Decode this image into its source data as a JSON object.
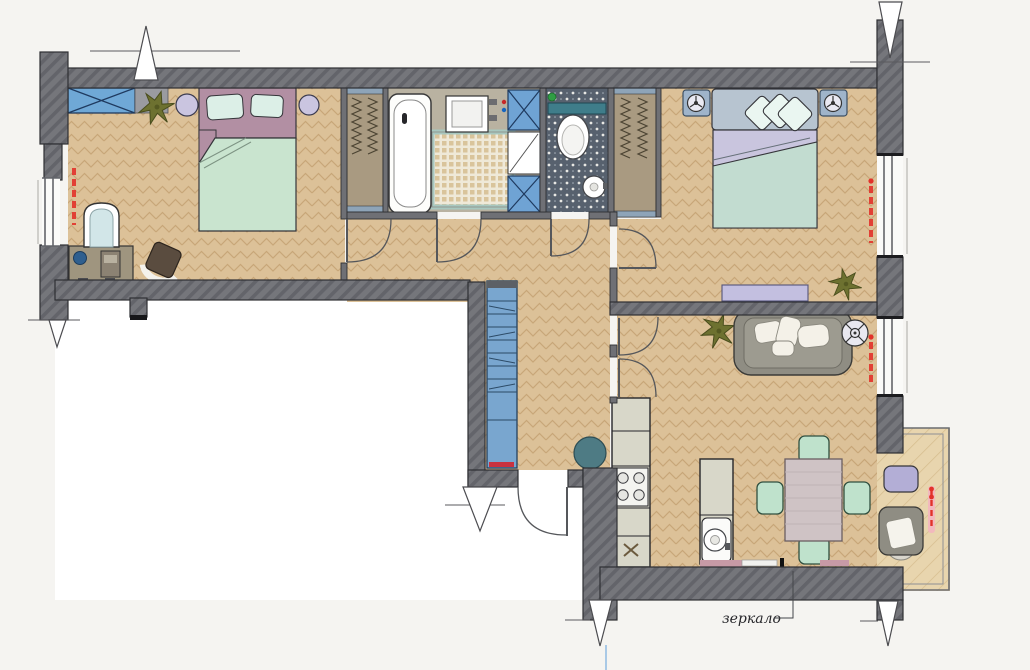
{
  "meta": {
    "type": "apartment-floor-plan",
    "view": "top-down 2D color render",
    "language": "ru"
  },
  "labels": {
    "mirror": "зеркало"
  },
  "colors": {
    "outside": "#f5f4f1",
    "stairwell": "#ffffff",
    "wall": "#75767b",
    "wall_hatch": "#64656b",
    "partition": "#6f7075",
    "floor_wood": "#dcc198",
    "floor_wood_line": "#c8a678",
    "balcony_wood": "#e8d5ae",
    "bath_floor": "#b9b2a1",
    "wc_floor": "#57616e",
    "closet": "#a99a81",
    "blue_unit": "#6fa3d4",
    "teal": "#3f7d8a",
    "mint": "#c9e4cf",
    "mauve_headboard": "#b28fa3",
    "lavender": "#c9c5de",
    "gray_headboard": "#b7c4d0",
    "sofa_gray": "#8f8d83",
    "chair_mint": "#bfe2cc",
    "table_mauve": "#cfc3c5",
    "plant_green": "#6d7130",
    "radiator": "#e2322a",
    "counter": "#d8d7c9",
    "mirror_strip": "#c79aa6"
  },
  "rooms": [
    {
      "name": "bedroom-1",
      "furniture": [
        "crossed-storage-box",
        "potted-plant",
        "round-bedside-table",
        "double-bed-mauve",
        "round-bedside-table",
        "window",
        "radiator",
        "dressing-table",
        "table-lamp",
        "desk-chair",
        "arched-mirror"
      ]
    },
    {
      "name": "closet-left",
      "furniture": [
        "clothes-rail-wardrobe"
      ]
    },
    {
      "name": "bathroom",
      "furniture": [
        "bathtub",
        "washbasin",
        "mosaic-mat",
        "ventilation-shaft",
        "tall-cabinet"
      ]
    },
    {
      "name": "wc",
      "furniture": [
        "toilet",
        "shelf",
        "corner-washbasin"
      ]
    },
    {
      "name": "closet-right",
      "furniture": [
        "clothes-rail-wardrobe"
      ]
    },
    {
      "name": "bedroom-2",
      "furniture": [
        "nightstand-with-lamp",
        "double-bed-gray",
        "nightstand-with-lamp",
        "bench",
        "potted-plant",
        "window",
        "radiator"
      ]
    },
    {
      "name": "hallway",
      "furniture": [
        "blue-shelving-unit",
        "entrance-door"
      ]
    },
    {
      "name": "kitchen",
      "furniture": [
        "kitchen-counter",
        "stove",
        "kitchen-sink",
        "fridge-cabinet",
        "round-table",
        "island-counter",
        "washing-machine"
      ]
    },
    {
      "name": "living-room",
      "furniture": [
        "sofa",
        "ceiling-fan",
        "potted-plant",
        "dining-table",
        "dining-chairs",
        "wall-mirror",
        "window",
        "radiator"
      ]
    },
    {
      "name": "balcony",
      "furniture": [
        "pouf",
        "armchair",
        "radiator",
        "glazing"
      ]
    }
  ]
}
